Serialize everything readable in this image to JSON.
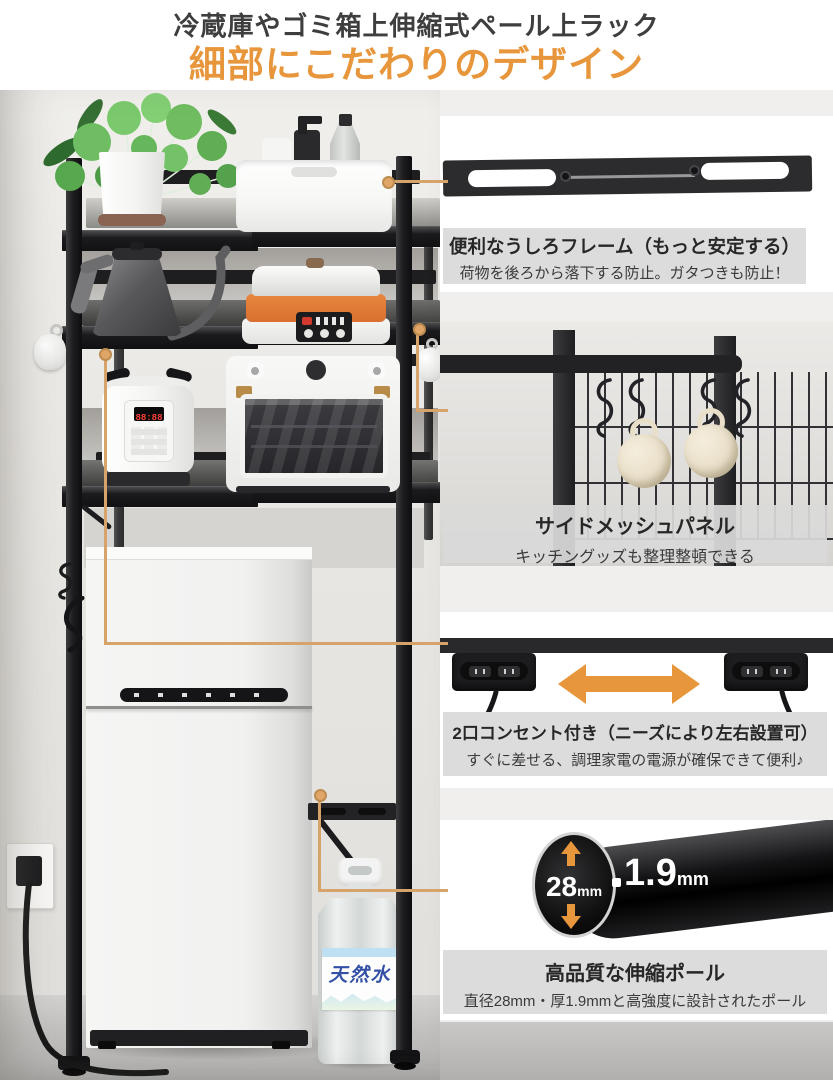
{
  "header": {
    "title": "冷蔵庫やゴミ箱上伸縮式ペール上ラック",
    "subtitle": "細部にこだわりのデザイン"
  },
  "features": [
    {
      "title": "便利なうしろフレーム（もっと安定する）",
      "desc": "荷物を後ろから落下する防止。ガタつきも防止！"
    },
    {
      "title": "サイドメッシュパネル",
      "desc": "キッチングッズも整理整頓できる"
    },
    {
      "title": "2口コンセント付き（ニーズにより左右設置可）",
      "desc": "すぐに差せる、調理家電の電源が確保できて便利♪"
    },
    {
      "title": "高品質な伸縮ポール",
      "desc": "直径28mm・厚1.9mmと高強度に設計されたポール"
    }
  ],
  "pole_spec": {
    "diameter_value": "28",
    "diameter_unit": "mm",
    "thickness_value": "1.9",
    "thickness_unit": "mm"
  },
  "scene": {
    "water_bottle_label": "天然水",
    "cooker_display": "88:88"
  },
  "colors": {
    "accent_orange": "#e8963c",
    "connector_gold": "#d6a36b",
    "caption_bg": "#dcdcdc",
    "label_blue": "#3350a5",
    "led_red": "#ff4136"
  }
}
